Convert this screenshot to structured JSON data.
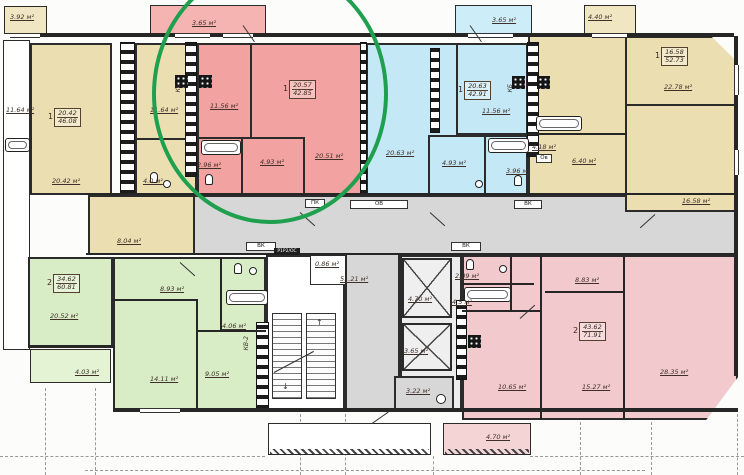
{
  "plan_title": "Residential floor plan with highlighted 1-room apartment",
  "highlight_color": "#1fa04e",
  "apartments": {
    "a1": {
      "num": "1",
      "living": "20.42",
      "total": "46.08",
      "balcony": "3.92 м²",
      "loggia": "11.64 м²",
      "main": "20.42 м²",
      "kitchen": "11.64 м²",
      "bath": "4.0 м²",
      "hall": "8.04 м²"
    },
    "a2": {
      "num": "1",
      "living": "20.57",
      "total": "42.85",
      "balcony": "3.65 м²",
      "kitchen": "11.56 м²",
      "main": "20.51 м²",
      "bath": "2.96 м²",
      "hall": "4.93 м²"
    },
    "a3": {
      "num": "1",
      "living": "20.63",
      "total": "42.91",
      "balcony": "3.65 м²",
      "kitchen": "11.56 м²",
      "main": "20.63 м²",
      "bath": "3.96 м²",
      "hall": "4.93 м²"
    },
    "a4": {
      "num": "1",
      "living": "16.58",
      "total": "52.73",
      "balcony": "4.40 м²",
      "kitchen": "6.40 м²",
      "bath": "4.18 м²",
      "room1": "22.78 м²",
      "room2": "16.58 м²",
      "ov": "Ов"
    },
    "a5": {
      "num": "2",
      "living": "34.62",
      "total": "60.81",
      "room1": "20.52 м²",
      "balcony": "4.03 м²",
      "kitchen": "8.93 м²",
      "room2": "14.11 м²",
      "room3": "9.05 м²",
      "bath": "4.06 м²",
      "shaft": "КВ-2"
    },
    "a6": {
      "num": "2",
      "living": "43.62",
      "total": "71.91",
      "wc": "2.09 м²",
      "bath": "4.5 м²",
      "hall": "10.65 м²",
      "kitchen": "8.83 м²",
      "room1": "15.27 м²",
      "room2": "28.35 м²",
      "balcony": "4.70 м²"
    }
  },
  "common": {
    "corridor": "51.21 м²",
    "closet": "0.86 м²",
    "lift1": "4.70 м²",
    "lift2": "3.65 м²",
    "refuse": "3.22 м²",
    "pk": "ПК",
    "ov": "ОВ",
    "vk": "ВК",
    "panel": "Р1Р2/ОС",
    "kb": "КБ"
  }
}
